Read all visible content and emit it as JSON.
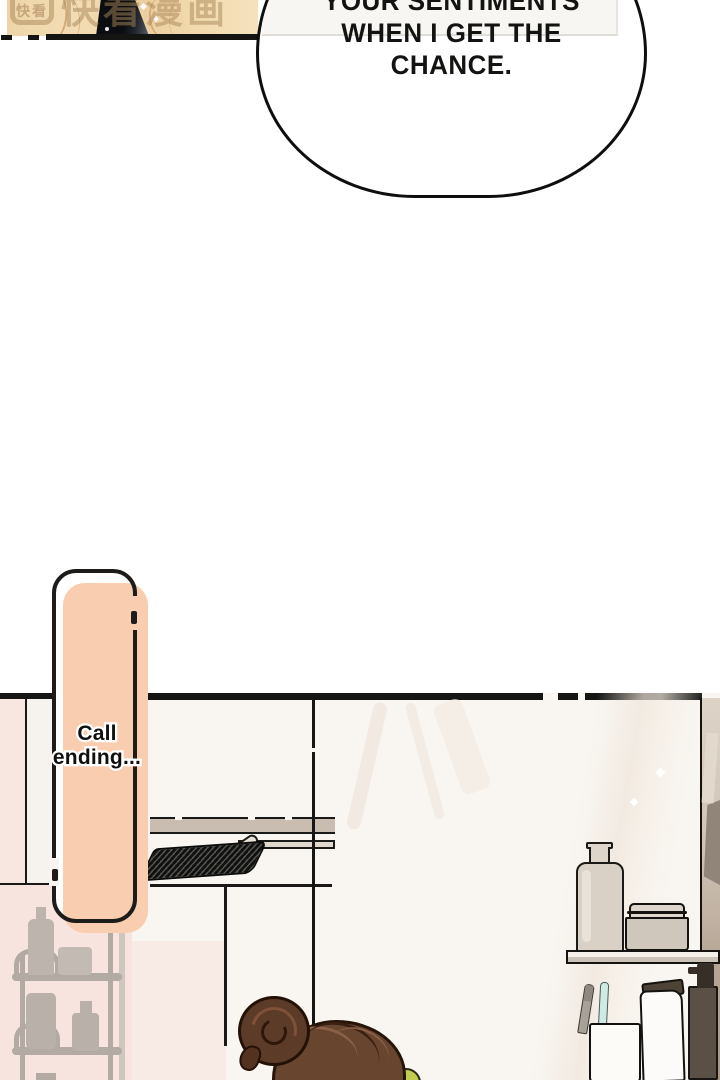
{
  "top_panel": {
    "watermark_logo": "快看",
    "watermark_text": "快看漫画"
  },
  "speech_bubble": {
    "lines": [
      "YOUR SENTIMENTS",
      "WHEN I GET THE",
      "CHANCE."
    ]
  },
  "call_bubble": {
    "lines": [
      "Call",
      "ending..."
    ]
  },
  "palette": {
    "peach": "#f8cdb0",
    "art_beige": "#f0d6aa",
    "wall_pink": "#f7e4de",
    "hair_brown": "#68452f",
    "towel_green": "#c2cb54",
    "outline_black": "#151514"
  }
}
